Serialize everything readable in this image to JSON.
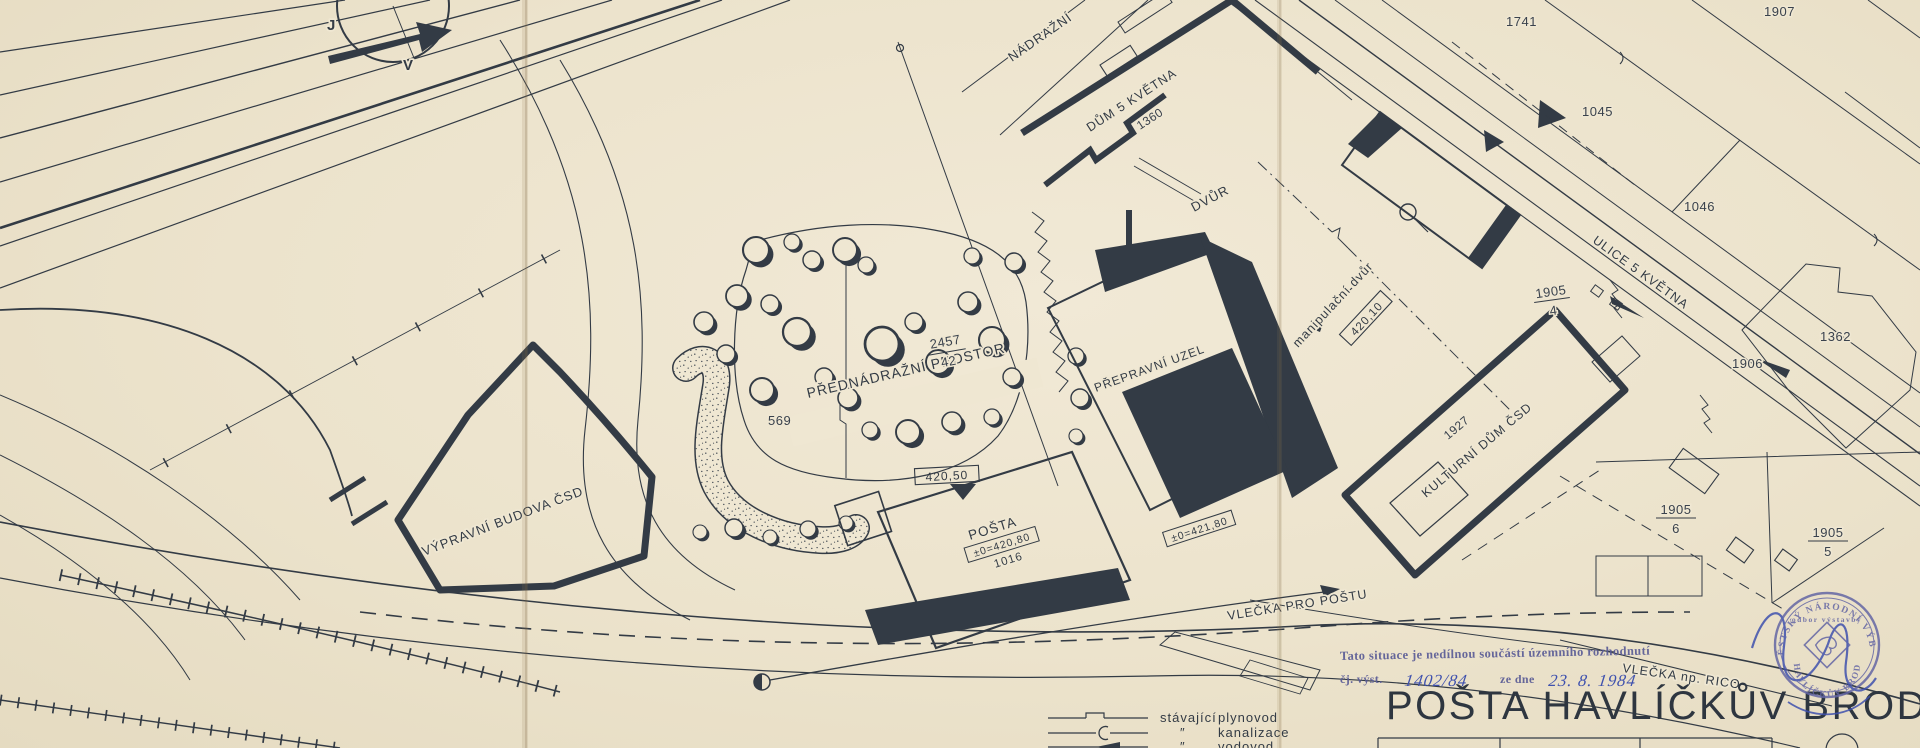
{
  "title": {
    "text": "POŠTA HAVLÍČKŮV BROD 2"
  },
  "colors": {
    "paper": "#efe7d2",
    "ink": "#333b45",
    "stamp_purple": "#6062a0",
    "pen_blue": "#3f51ae"
  },
  "compass": {
    "j": "J",
    "v": "V"
  },
  "labels": {
    "station_building": "VÝPRAVNÍ BUDOVA ČSD",
    "forecourt": "PŘEDNÁDRAŽNÍ PROSTOR",
    "parcel_569": "569",
    "frac_2457_n": "2457",
    "frac_2457_d": "42",
    "elev_420_50": "420,50",
    "street_nadrazni": "NÁDRAŽNÍ",
    "house_5_kvetna": "DŮM 5 KVĚTNA",
    "house_5_kvetna_no": "1360",
    "courtyard": "DVŮR",
    "transport_hub": "PŘEPRAVNÍ UZEL",
    "handling_yard": "manipulační dvůr",
    "elev_420_10": "420,10",
    "frac_1905_4_n": "1905",
    "frac_1905_4_d": "4",
    "culture_house_year": "1927",
    "culture_house": "KULTURNÍ DŮM ČSD",
    "street_5_kvetna": "ULICE 5 KVĚTNA",
    "p_1741": "1741",
    "p_1907": "1907",
    "p_1045": "1045",
    "p_1046": "1046",
    "p_1362": "1362",
    "p_1906": "1906",
    "frac_1905_6_n": "1905",
    "frac_1905_6_d": "6",
    "frac_1905_5_n": "1905",
    "frac_1905_5_d": "5",
    "post_office": "POŠTA",
    "post_elev": "±0=420,80",
    "post_no": "1016",
    "hub_elev": "±0=421,80",
    "siding_post": "VLEČKA PRO POŠTU",
    "siding_rico": "VLEČKA np. RICO"
  },
  "note": {
    "stamp_text": "Tato situace je nedílnou součástí územního rozhodnutí",
    "ref_label": "čj. výst.",
    "ref_value": "1402/84",
    "date_label": "ze dne",
    "date_value": "23. 8. 1984"
  },
  "legend": {
    "prefix": "stávající",
    "ditto": "″",
    "items": [
      "plynovod",
      "kanalizace",
      "vodovod"
    ]
  },
  "stamp": {
    "ring_top": "MĚSTSKÝ NÁRODNÍ VÝBOR",
    "ring_bottom": "HAVLÍČKŮV BROD",
    "dept": "odbor výstavby"
  }
}
